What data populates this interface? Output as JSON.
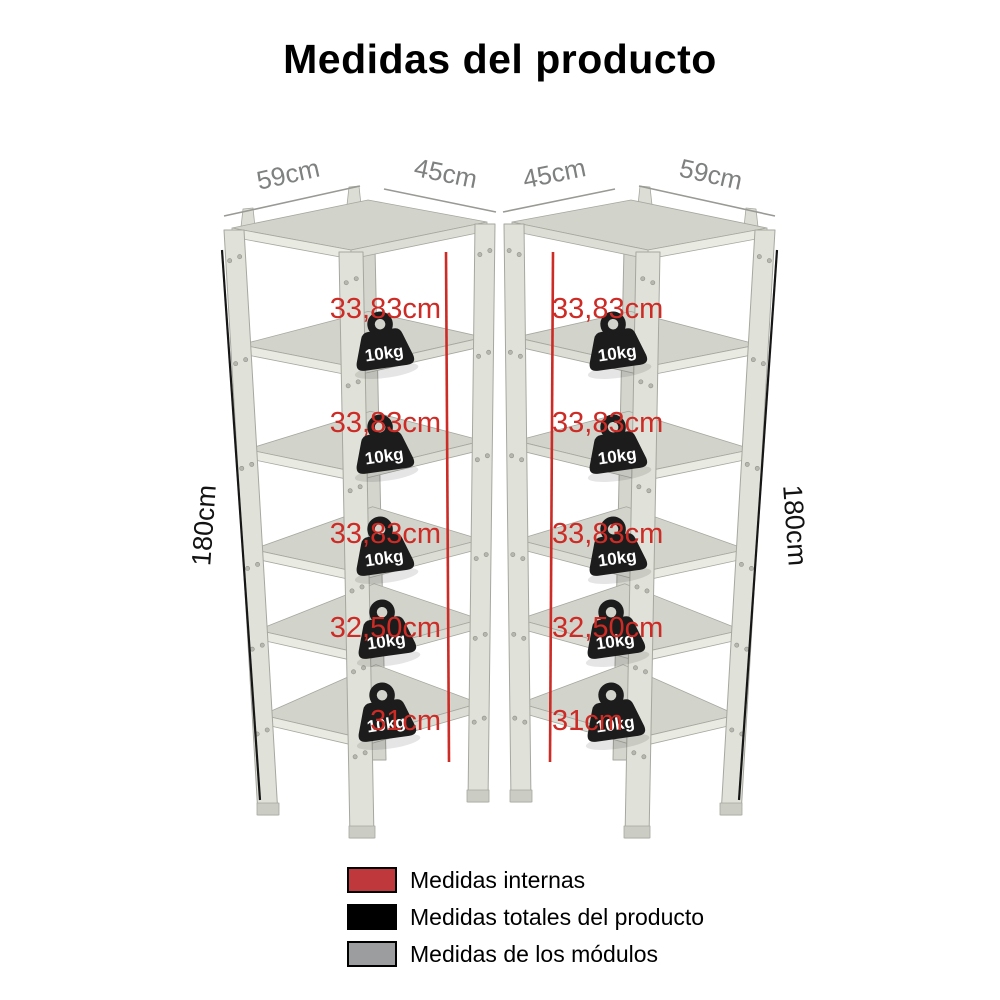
{
  "title": "Medidas del producto",
  "units": [
    {
      "side": "left",
      "width_dim": "59cm",
      "depth_dim": "45cm",
      "height_dim": "180cm",
      "internal_dims": [
        "33,83cm",
        "33,83cm",
        "33,83cm",
        "32,50cm",
        "31cm"
      ],
      "shelf_weights": [
        "10kg",
        "10kg",
        "10kg",
        "10kg",
        "10kg"
      ]
    },
    {
      "side": "right",
      "width_dim": "59cm",
      "depth_dim": "45cm",
      "height_dim": "180cm",
      "internal_dims": [
        "33,83cm",
        "33,83cm",
        "33,83cm",
        "32,50cm",
        "31cm"
      ],
      "shelf_weights": [
        "10kg",
        "10kg",
        "10kg",
        "10kg",
        "10kg"
      ]
    }
  ],
  "legend": {
    "items": [
      {
        "label": "Medidas internas",
        "color": "#bf383b"
      },
      {
        "label": "Medidas totales del producto",
        "color": "#000000"
      },
      {
        "label": "Medidas de los módulos",
        "color": "#9c9d9e"
      }
    ]
  },
  "colors": {
    "internal_dim_red": "#cc2b26",
    "total_dim_black": "#121212",
    "module_dim_gray": "#7f8080",
    "shelf_surface": "#d2d3cb"
  },
  "icons": {
    "weight-icon": "10kg weight on each shelf"
  }
}
